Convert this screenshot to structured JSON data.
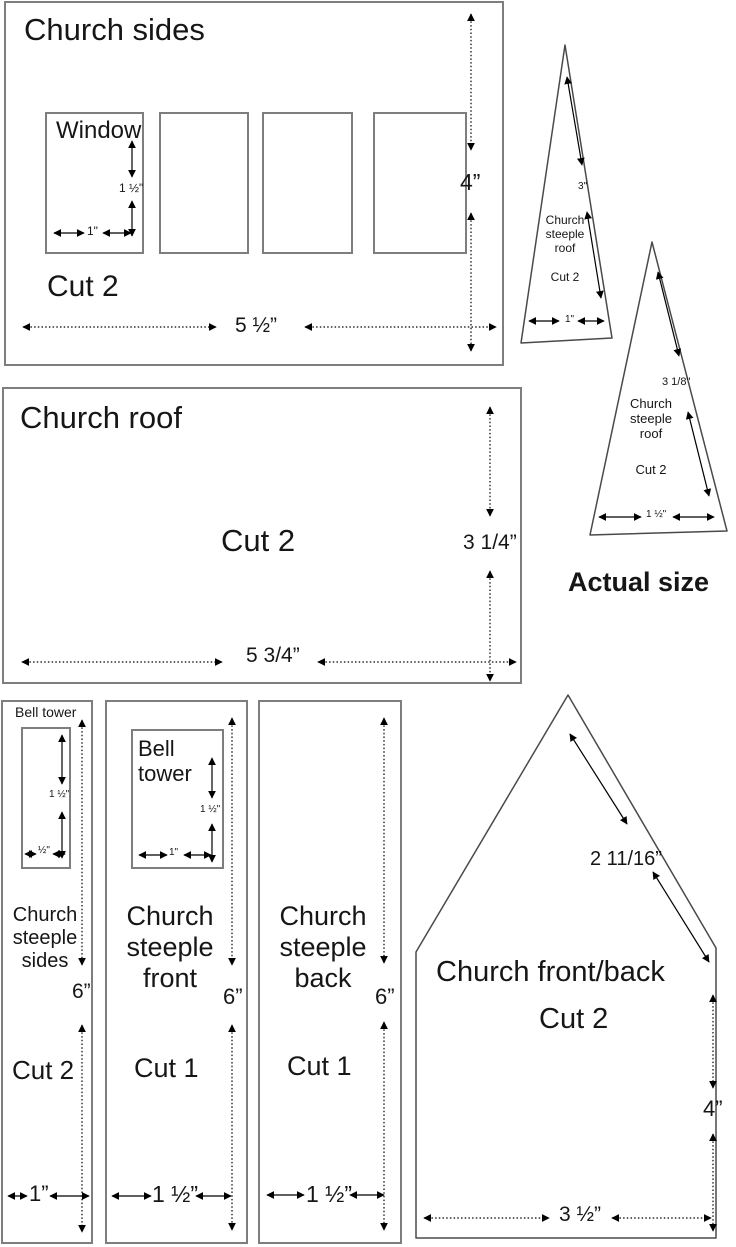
{
  "colors": {
    "box_border": "#7e7e7e",
    "shape_line": "#4a4a4a",
    "dim_line": "#000000",
    "background": "#ffffff"
  },
  "church_sides": {
    "title": "Church sides",
    "cut": "Cut 2",
    "window": {
      "label": "Window",
      "height": "1 ½\"",
      "width": "1\""
    },
    "height": "4”",
    "width": "5 ½”"
  },
  "steeple_roof_left": {
    "name": "Church\nsteeple\nroof",
    "cut": "Cut 2",
    "slant": "3\"",
    "base": "1\""
  },
  "steeple_roof_right": {
    "name": "Church\nsteeple\nroof",
    "cut": "Cut 2",
    "slant": "3 1/8\"",
    "base": "1 ½\""
  },
  "actual_size": "Actual size",
  "church_roof": {
    "title": "Church roof",
    "cut": "Cut 2",
    "height": "3 1/4”",
    "width": "5 3/4”"
  },
  "steeple_sides": {
    "bell_label": "Bell tower",
    "bell_height": "1 ½\"",
    "bell_width": "½\"",
    "name": "Church\nsteeple\nsides",
    "height": "6”",
    "cut": "Cut 2",
    "width": "1”"
  },
  "steeple_front": {
    "bell_label": "Bell\ntower",
    "bell_height": "1 ½\"",
    "bell_width": "1\"",
    "name": "Church\nsteeple\nfront",
    "height": "6”",
    "cut": "Cut 1",
    "width": "1 ½”"
  },
  "steeple_back": {
    "name": "Church\nsteeple\nback",
    "height": "6”",
    "cut": "Cut 1",
    "width": "1 ½”"
  },
  "church_front_back": {
    "name": "Church front/back",
    "cut": "Cut 2",
    "slant": "2 11/16”",
    "height": "4”",
    "width": "3 ½”"
  }
}
